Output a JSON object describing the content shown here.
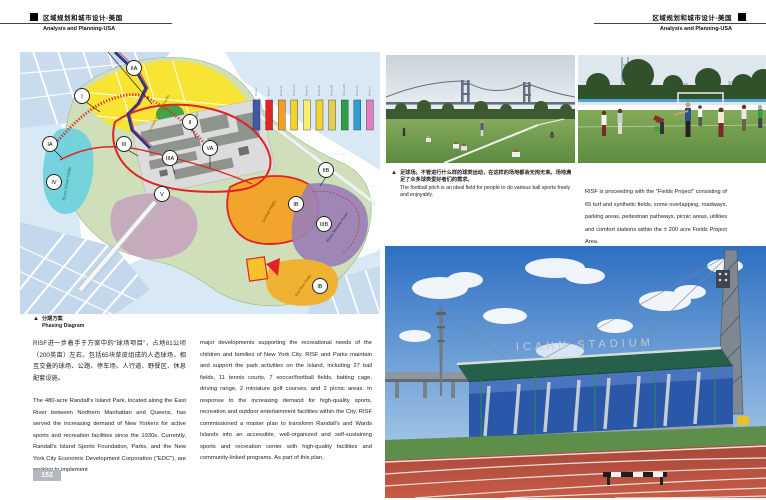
{
  "headers": {
    "left": {
      "zh": "区域规划和城市设计-美国",
      "en": "Analysis and Planning-USA"
    },
    "right": {
      "zh": "区域规划和城市设计-美国",
      "en": "Analysis and Planning-USA"
    }
  },
  "map": {
    "caption_zh": "分期方案",
    "caption_en": "Phasing Diagram",
    "areas": {
      "sunken_meadow": "Sunken Meadow Fields",
      "bronx_shore": "Bronx Shore Fields",
      "tennis_center": "Tennis Center",
      "central_fields": "Central Fields",
      "wards_meadow": "Wards Meadow Fields",
      "east_river": "East River Fields"
    },
    "markers": [
      "IA",
      "I",
      "IIA",
      "II",
      "III",
      "IIIA",
      "VA",
      "V",
      "IV",
      "IIB",
      "IB",
      "IIIB",
      "IB"
    ],
    "legend": {
      "items": [
        {
          "label": "Phase I",
          "color": "#3d59a8"
        },
        {
          "label": "Phase II",
          "color": "#e02428"
        },
        {
          "label": "Phase III",
          "color": "#f49e22"
        },
        {
          "label": "Phase IIA",
          "color": "#f5d22a"
        },
        {
          "label": "Phase IA",
          "color": "#f9ee70"
        },
        {
          "label": "Phase IB",
          "color": "#f3d232"
        },
        {
          "label": "Phase IIB",
          "color": "#e4cf52"
        },
        {
          "label": "Phase IIIB",
          "color": "#2f9e47"
        },
        {
          "label": "Phase IV",
          "color": "#2f9fd4"
        },
        {
          "label": "Phase V",
          "color": "#e07fc1"
        }
      ]
    }
  },
  "columns": {
    "col1_zh": "RISF进一步着手于方案中的“球场项目”，占地81公顷（200英亩）左右，包括65块草皮组成的人造球场，相互交叠的球场、公路、停车场、人行道、野餐区、休息配套设施。",
    "col1_en": "The 480-acre Randall's Island Park, located along the East River between Northern Manhattan and Queens, has served the increasing demand of New Yorkers for active sports and recreation facilities since the 1930s. Currently, Randall's Island Sports Foundation, Parks, and the New York City Economic Development Corporation (\"EDC\"), are working to implement",
    "col2_en": "major developments supporting the recreational needs of the children and families of New York City. RISF and Parks maintain and support the park activities on the Island, including 27 ball fields, 11 tennis courts, 7 soccer/football fields, batting cage, driving range, 2 miniature golf courses, and 2 picnic areas. In response to the increasing demand for high-quality sports, recreation and outdoor entertainment facilities within the City, RISF commissioned a master plan to transform Randall's and Wards Islands into an accessible, well-organized and self-sustaining sports and recreation center with high-quality facilities and community-linked programs. As part of this plan,"
  },
  "captions": {
    "football_zh": "足球场。不管进行什么样的球类运动，在这样的场地都会无拘无束。场地满足了众多球类爱好者们的需求。",
    "football_en": "The football pitch is an ideal field for people to do various ball sports freely and enjoyably.",
    "fields_project": "RISF is proceeding with the \"Fields Project\" consisting of 65 turf and synthetic fields, some overlapping, roadways, parking areas, pedestrian pathways, picnic areas, utilities and comfort stations within the ± 200 acre Fields Project Area."
  },
  "photos": {
    "stadium": {
      "sign": "ICAHN STADIUM"
    }
  },
  "page": {
    "number": "152"
  }
}
